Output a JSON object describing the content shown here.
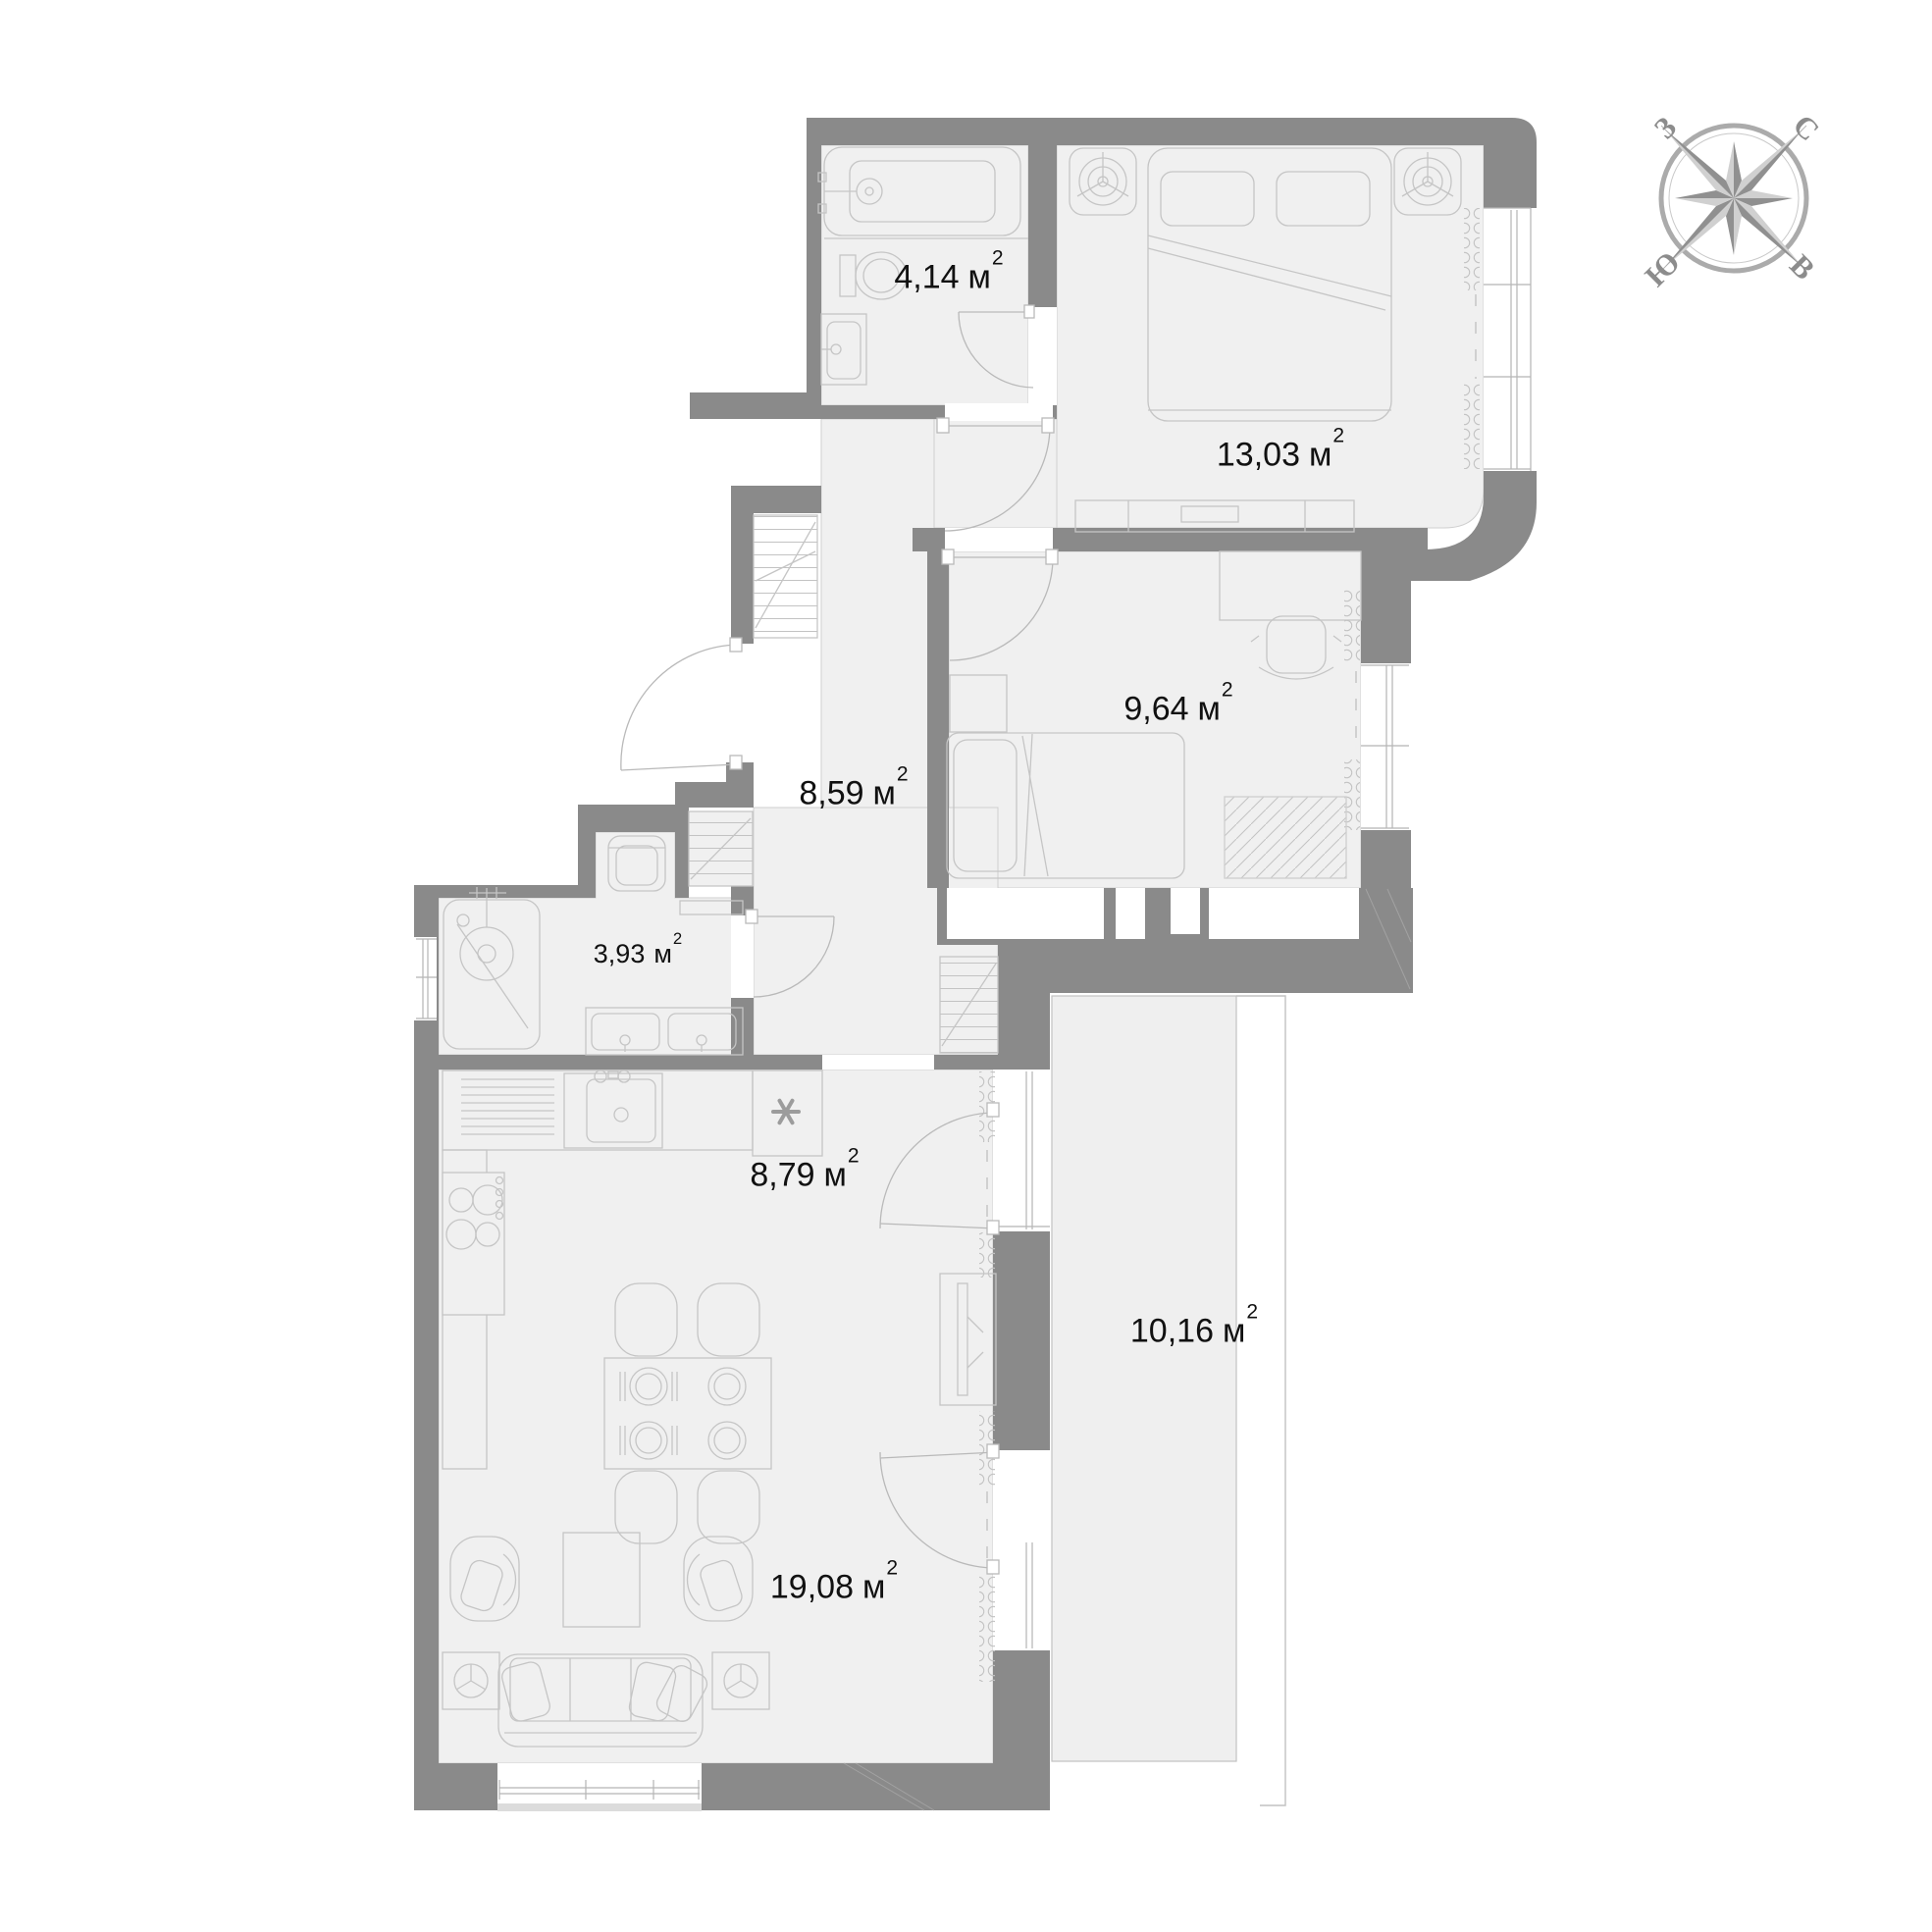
{
  "plan": {
    "type": "apartment floor plan",
    "wall_color": "#8a8a8a",
    "floor_color": "#f0f0f0",
    "line_color": "#c5c5c5"
  },
  "compass": {
    "north": "С",
    "east": "В",
    "south": "Ю",
    "west": "З"
  },
  "rooms": [
    {
      "name": "ensuite-bathroom",
      "area": "4,14",
      "unit": "м",
      "sup": "2"
    },
    {
      "name": "bedroom",
      "area": "13,03",
      "unit": "м",
      "sup": "2"
    },
    {
      "name": "bedroom-2",
      "area": "9,64",
      "unit": "м",
      "sup": "2"
    },
    {
      "name": "hallway",
      "area": "8,59",
      "unit": "м",
      "sup": "2"
    },
    {
      "name": "bathroom",
      "area": "3,93",
      "unit": "м",
      "sup": "2"
    },
    {
      "name": "kitchen",
      "area": "8,79",
      "unit": "м",
      "sup": "2"
    },
    {
      "name": "balcony",
      "area": "10,16",
      "unit": "м",
      "sup": "2"
    },
    {
      "name": "living-room",
      "area": "19,08",
      "unit": "м",
      "sup": "2"
    }
  ]
}
